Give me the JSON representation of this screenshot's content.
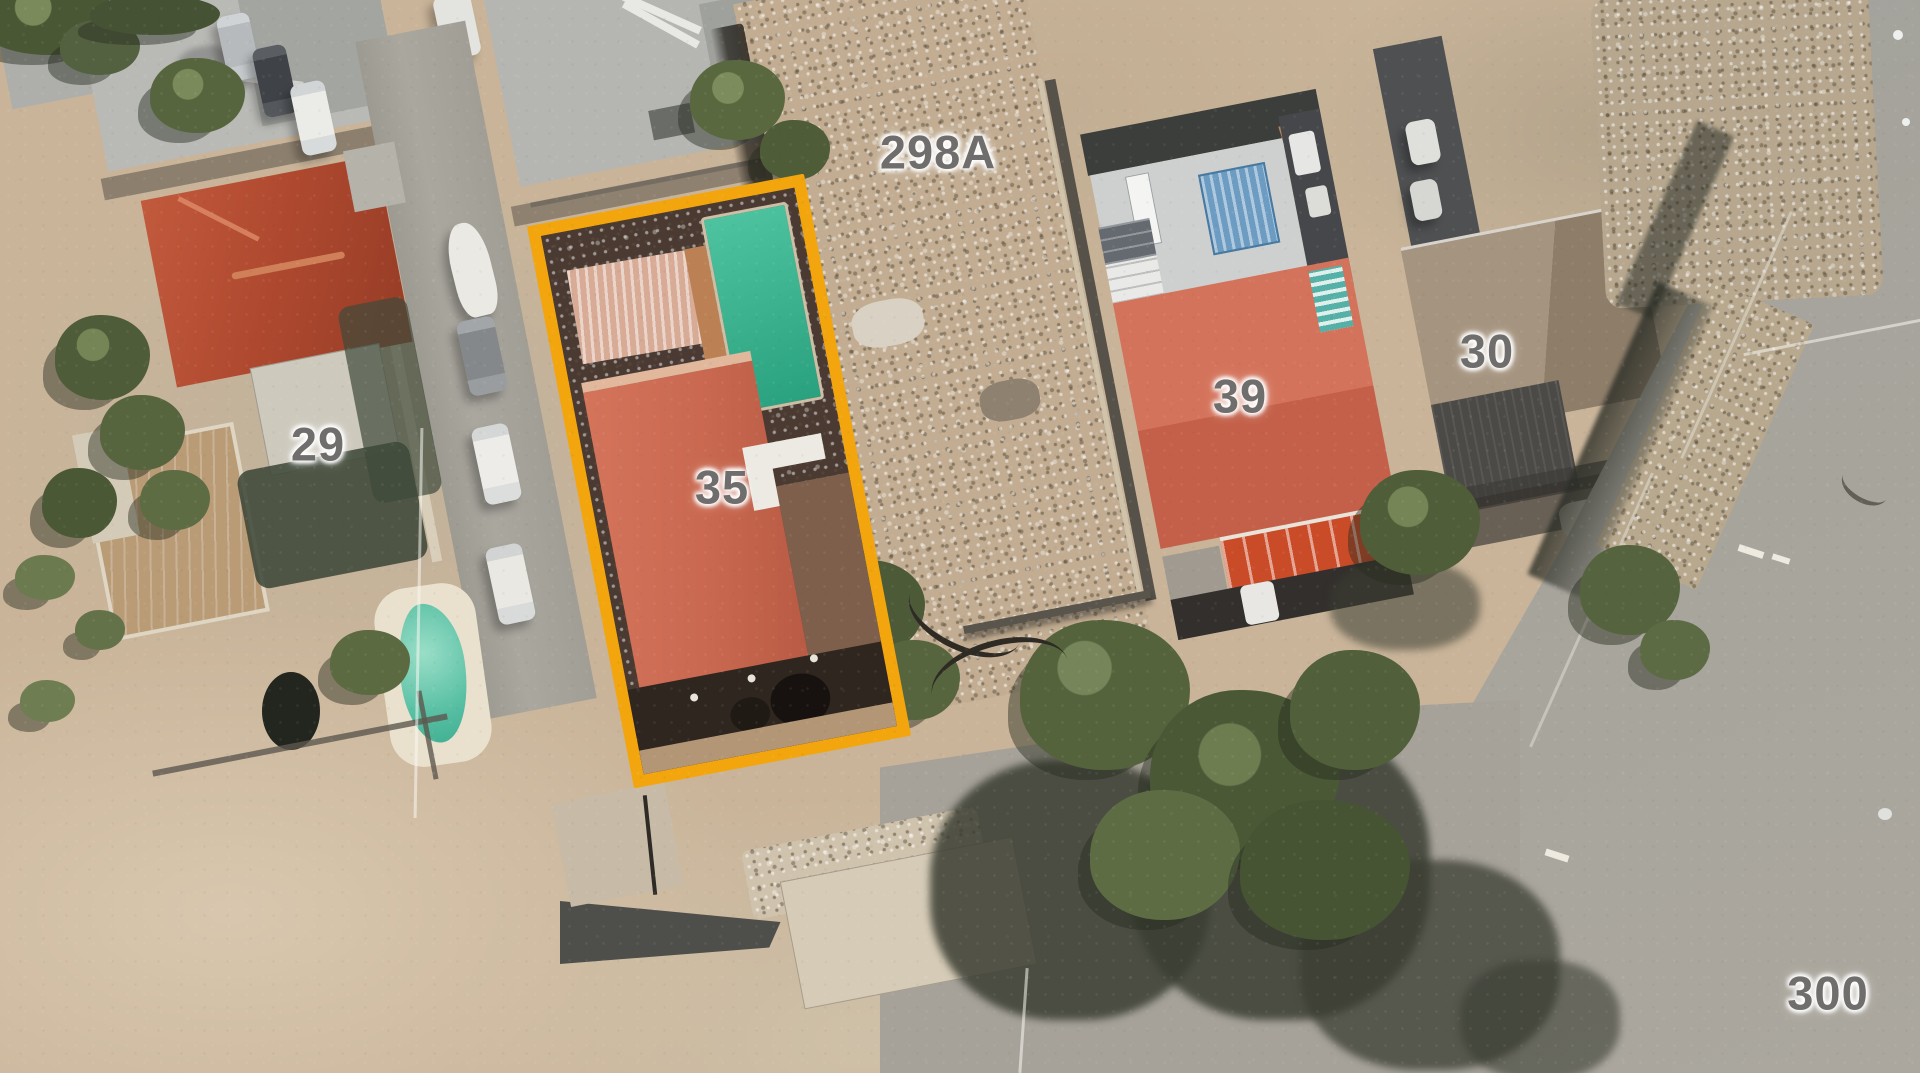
{
  "view": {
    "description": "Aerial satellite photo of residential parcels with one parcel outlined",
    "highlighted_parcel": "35",
    "highlight_color": "#F2A50C"
  },
  "labels": {
    "parcel_29": "29",
    "parcel_35": "35",
    "parcel_39": "39",
    "parcel_30": "30",
    "lot_298a": "298A",
    "road_300": "300"
  },
  "colors": {
    "highlight_border": "#F2A50C",
    "label_text": "#6F6E6C",
    "ground_dirt": "#C9B499",
    "road_gray": "#A5A39B",
    "roof_red_29": "#B04A30",
    "roof_salmon_35": "#CC6B53",
    "roof_salmon_39": "#D06F58",
    "roof_gray_30": "#9C8D7A",
    "metal_roof": "#CED0D0",
    "skylight_blue": "#6D9CC2",
    "pool_green_35": "#3BB892",
    "pool_teal_29": "#59C0A4",
    "tree_green": "#4E5C3A"
  }
}
